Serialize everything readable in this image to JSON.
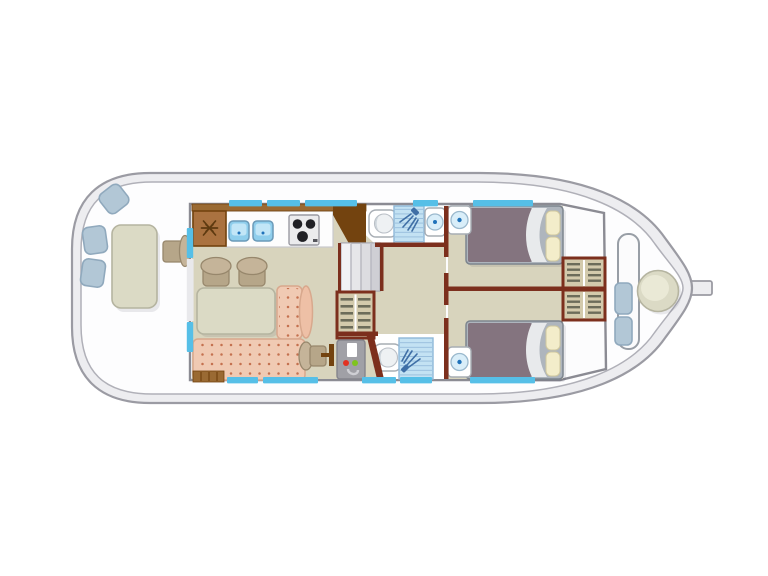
{
  "colors": {
    "hull_line": "#9b9ba3",
    "hull_line2": "#b0b0b8",
    "hull_rim": "#ededf0",
    "deck": "#fdfdfe",
    "cabin_wall": "#8b8b93",
    "cabin_fill": "#fcfcfd",
    "window_blue": "#56bfe7",
    "floor": "#d8d4bd",
    "maroon": "#7c2f1d",
    "wood_band": "#9a6a33",
    "wood_dark": "#73430f",
    "fridge": "#aa7240",
    "counter_white": "#fdfdfd",
    "sink_blue": "#8fceec",
    "sink_light": "#c2e6f7",
    "sink_stroke": "#6b9ab8",
    "accent_dot": "#1f72ba",
    "stove_gray": "#ebebed",
    "burner": "#202025",
    "tan_back": "#c5b499",
    "tan_seat": "#b6a689",
    "tan_stroke": "#97876c",
    "table_green": "#dbdac5",
    "table_stroke": "#b5b4a0",
    "sofa": "#f0cab3",
    "sofa_arm": "#eec0a6",
    "sofa_dot": "#c4714f",
    "sofa_stroke": "#d8a88d",
    "step_gray": "#e6e6e9",
    "wardrobe_fill": "#d3caac",
    "slat": "#6c6c5a",
    "bed_frame": "#aeb5bd",
    "duvet": "#84747f",
    "fold": "#e8eaec",
    "pillow": "#f3edca",
    "pillow_stroke": "#cfc79e",
    "fixture_stroke": "#a7adb4",
    "tile": "#c3e2f3",
    "tile_stroke": "#8fb8d8",
    "shower_head": "#3f6fa6",
    "basin": "#d9eef9",
    "basin_stroke": "#9bb9cd",
    "panel_gray": "#a0a0a6",
    "indicator_red": "#e23222",
    "indicator_green": "#7fc41e",
    "seat_blue": "#b2c7d6",
    "seat_blue_stroke": "#90a9bd",
    "bench_stroke": "#989ea6"
  },
  "diagram": {
    "type": "houseboat-deck-plan-top-view",
    "orientation": "bow-right",
    "areas": [
      {
        "name": "aft-deck",
        "furniture": [
          "deck-table",
          "deck-seat",
          "deck-seat",
          "deck-seat",
          "helm-seat"
        ]
      },
      {
        "name": "salon-galley",
        "furniture": [
          "fridge",
          "double-sink",
          "stove",
          "counter",
          "dinette-table",
          "dinette-chair",
          "dinette-chair",
          "l-shaped-sofa",
          "pilot-chair",
          "entry-steps"
        ]
      },
      {
        "name": "midship",
        "furniture": [
          "companionway-steps",
          "wardrobe",
          "electrical-panel"
        ]
      },
      {
        "name": "bathroom-top",
        "furniture": [
          "toilet",
          "shower",
          "washbasin"
        ]
      },
      {
        "name": "bathroom-bottom",
        "furniture": [
          "toilet",
          "shower"
        ]
      },
      {
        "name": "cabin-top",
        "furniture": [
          "double-bed",
          "washbasin",
          "wardrobe"
        ]
      },
      {
        "name": "cabin-bottom",
        "furniture": [
          "double-bed",
          "washbasin",
          "wardrobe"
        ]
      },
      {
        "name": "bow-deck",
        "furniture": [
          "bench",
          "cushion",
          "cushion",
          "round-table"
        ]
      }
    ],
    "icons": [
      "snowflake-icon",
      "shower-head-icon",
      "stove-burner-icon"
    ]
  }
}
